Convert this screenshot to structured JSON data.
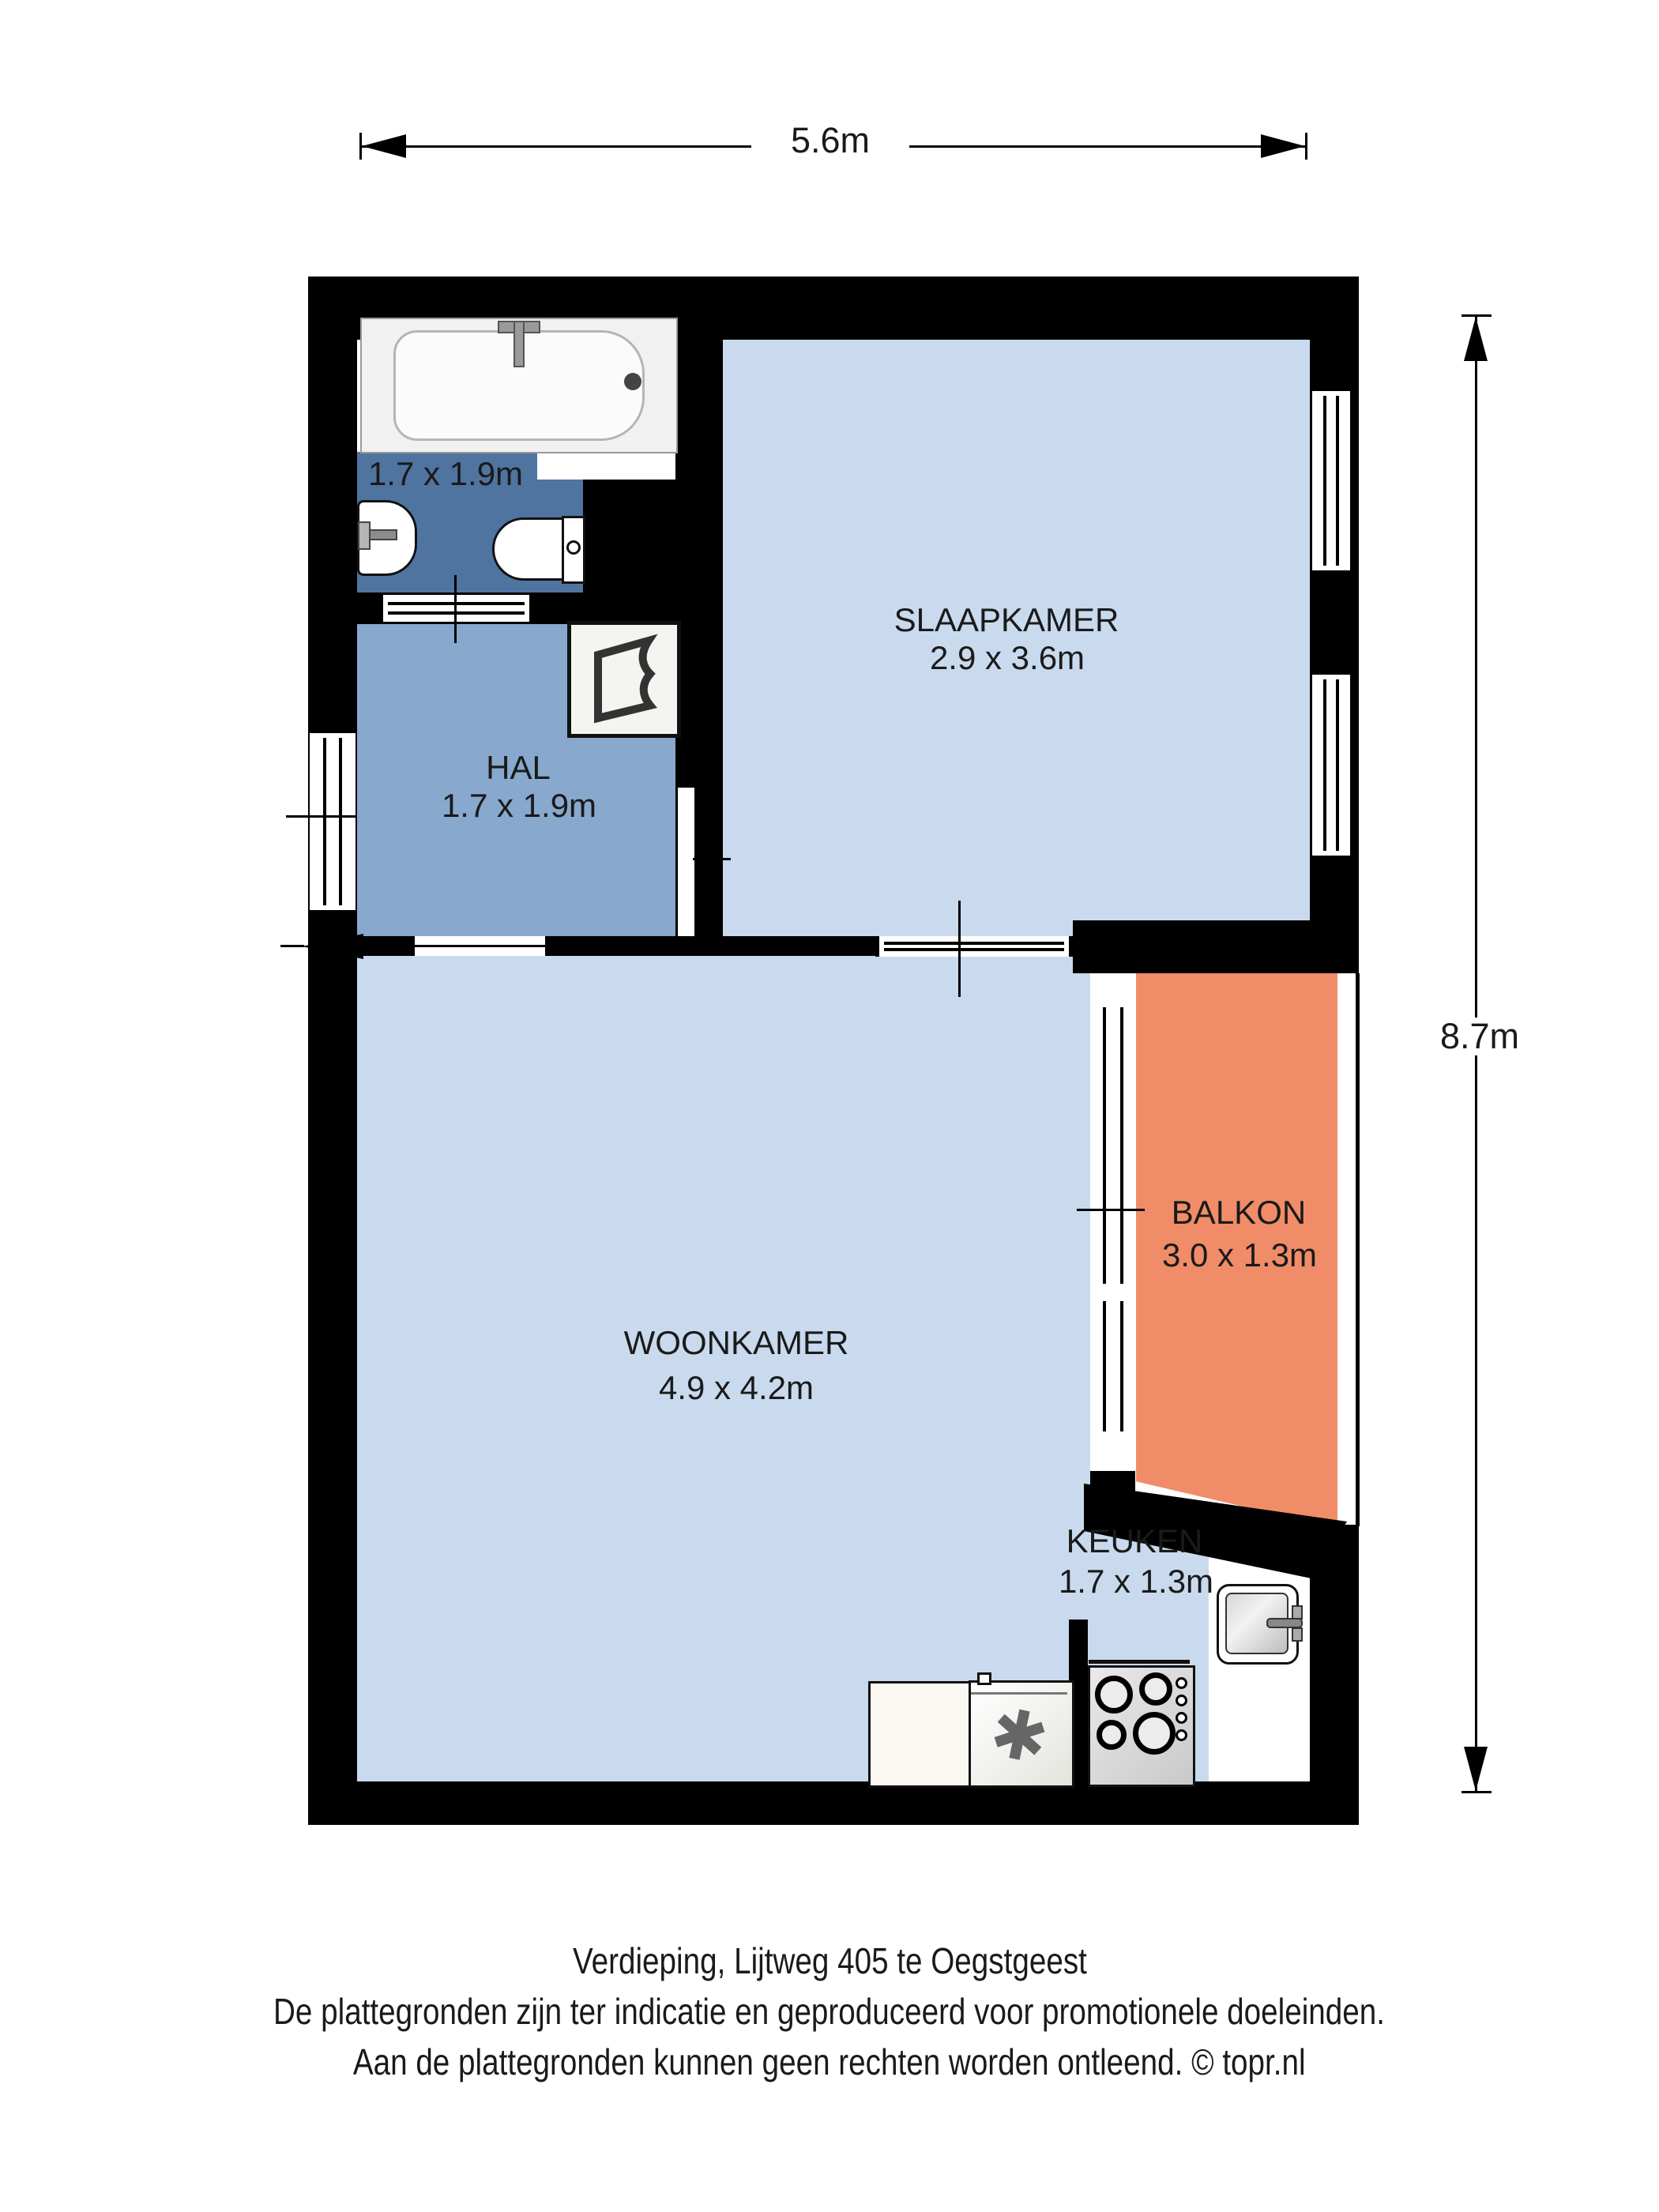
{
  "dimensions": {
    "top": "5.6m",
    "right": "8.7m"
  },
  "rooms": {
    "badkamer": {
      "dims": "1.7 x 1.9m"
    },
    "hal": {
      "name": "HAL",
      "dims": "1.7 x 1.9m"
    },
    "slaapkamer": {
      "name": "SLAAPKAMER",
      "dims": "2.9 x 3.6m"
    },
    "woonkamer": {
      "name": "WOONKAMER",
      "dims": "4.9 x 4.2m"
    },
    "balkon": {
      "name": "BALKON",
      "dims": "3.0 x 1.3m"
    },
    "keuken": {
      "name": "KEUKEN",
      "dims": "1.7 x 1.3m"
    }
  },
  "footer": {
    "line1": "Verdieping, Lijtweg 405 te Oegstgeest",
    "line2": "De plattegronden zijn ter indicatie en geproduceerd voor promotionele doeleinden.",
    "line3": "Aan de plattegronden kunnen geen rechten worden ontleend. © topr.nl"
  },
  "icons": {
    "freezer_star": "✱"
  },
  "colors": {
    "wall": "#000000",
    "floor-light": "#C9DAEE",
    "floor-hal": "#88A8CD",
    "floor-bath": "#4F74A0",
    "floor-balkon": "#F08D68",
    "text": "#1A1A1A"
  }
}
